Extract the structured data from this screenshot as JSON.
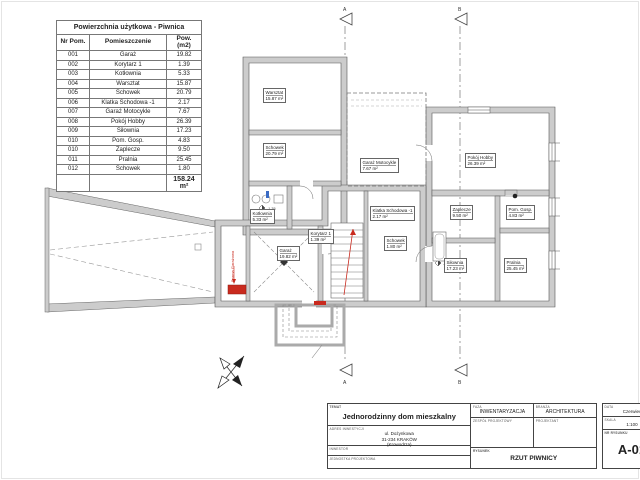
{
  "area_table": {
    "title": "Powierzchnia użytkowa - Piwnica",
    "columns": [
      "Nr Pom.",
      "Pomieszczenie",
      "Pow. (m2)"
    ],
    "rows": [
      [
        "001",
        "Garaż",
        "19.82"
      ],
      [
        "002",
        "Korytarz 1",
        "1.39"
      ],
      [
        "003",
        "Kotłownia",
        "5.33"
      ],
      [
        "004",
        "Warsztat",
        "15.87"
      ],
      [
        "005",
        "Schowek",
        "20.79"
      ],
      [
        "006",
        "Klatka Schodowa -1",
        "2.17"
      ],
      [
        "007",
        "Garaż Motocykle",
        "7.67"
      ],
      [
        "008",
        "Pokój Hobby",
        "26.39"
      ],
      [
        "009",
        "Siłownia",
        "17.23"
      ],
      [
        "010",
        "Pom. Gosp.",
        "4.83"
      ],
      [
        "010",
        "Zaplecze",
        "9.50"
      ],
      [
        "011",
        "Pralnia",
        "25.45"
      ],
      [
        "012",
        "Schowek",
        "1.80"
      ]
    ],
    "total": "158.24 m²"
  },
  "plan": {
    "labels": [
      {
        "name": "Garaż",
        "area": "19.82 m²"
      },
      {
        "name": "Korytarz 1",
        "area": "1.39 m²"
      },
      {
        "name": "Kotłownia",
        "area": "5.33 m²"
      },
      {
        "name": "Warsztat",
        "area": "15.87 m²"
      },
      {
        "name": "Schowek",
        "area": "20.79 m²"
      },
      {
        "name": "Klatka Schodowa -1",
        "area": "2.17 m²"
      },
      {
        "name": "Garaż Motocykle",
        "area": "7.67 m²"
      },
      {
        "name": "Pokój Hobby",
        "area": "26.39 m²"
      },
      {
        "name": "Siłownia",
        "area": "17.23 m²"
      },
      {
        "name": "Pom. Gosp.",
        "area": "4.83 m²"
      },
      {
        "name": "Zaplecze",
        "area": "9.50 m²"
      },
      {
        "name": "Pralnia",
        "area": "25.45 m²"
      },
      {
        "name": "Schowek",
        "area": "1.80 m²"
      }
    ],
    "sections": [
      "A",
      "B",
      "A",
      "B"
    ],
    "garage_door_label": "Brama Garażowa",
    "level_label": "-1,35"
  },
  "title_block": {
    "temat_label": "TEMAT",
    "temat": "Jednorodzinny dom mieszkalny",
    "adres_label": "ADRES INWESTYCJI",
    "adres_1": "ul. Dożynkowa",
    "adres_2": "31-234 KRAKÓW",
    "adres_3": "(Krowodrza)",
    "inwestor_label": "INWESTOR",
    "jednostka_label": "JEDNOSTKA PROJEKTOWA",
    "faza_label": "FAZA",
    "faza": "INWENTARYZACJA",
    "branza_label": "BRANŻA",
    "branza": "ARCHITEKTURA",
    "zespol_label": "ZESPÓŁ PROJEKTOWY",
    "projektant_label": "PROJEKTANT",
    "rysunek_label": "RYSUNEK",
    "rysunek": "RZUT PIWNICY",
    "data_label": "DATA",
    "data": "Czerwiec",
    "skala_label": "SKALA",
    "skala": "1:100",
    "numer_label": "NR RYSUNKU",
    "numer": "A-01"
  },
  "colors": {
    "accent_red": "#c92a1e",
    "wall_gray": "#cccccc",
    "line_gray": "#555555",
    "accent_blue": "#3a6bc4"
  }
}
